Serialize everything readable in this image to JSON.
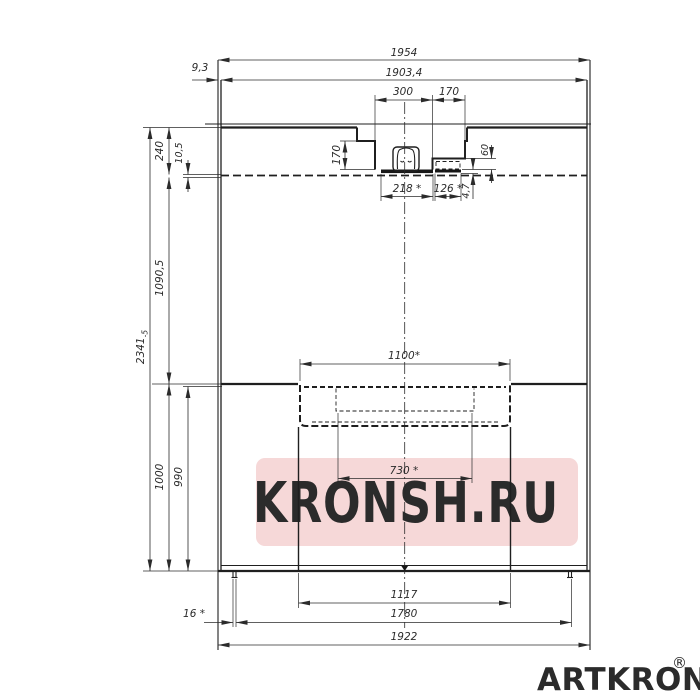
{
  "page": {
    "background": "#ffffff"
  },
  "watermark": {
    "text": "KRONSH.RU",
    "banner_color": "#f6d8d8",
    "text_color": "#fdf4f4"
  },
  "brand": {
    "name": "ARTKRON",
    "registered_mark": "®",
    "color": "#111111"
  },
  "drawing": {
    "line_color": "#1f1f1f",
    "dim_color": "#2b2b2b",
    "dims": {
      "overall_width": "1954",
      "body_width": "1903,4",
      "left_offset": "9,3",
      "notch_width": "300",
      "recess_width": "170",
      "notch_depth": "170",
      "plate_width": "218 *",
      "plate2_width": "126 *",
      "plate_gap": "4,7",
      "recess_depth": "60",
      "top_flange": "240",
      "top_lip": "10,5",
      "upper_height": "1090,5",
      "total_height": "2341",
      "total_height_tol": "-5",
      "lower_height": "1000",
      "lower_inner_height": "990",
      "tray_width": "1100*",
      "tray_inner_width": "730 *",
      "base_width": "1117",
      "feet_span": "1780",
      "bottom_width": "1922",
      "foot_offset": "16 *"
    }
  }
}
